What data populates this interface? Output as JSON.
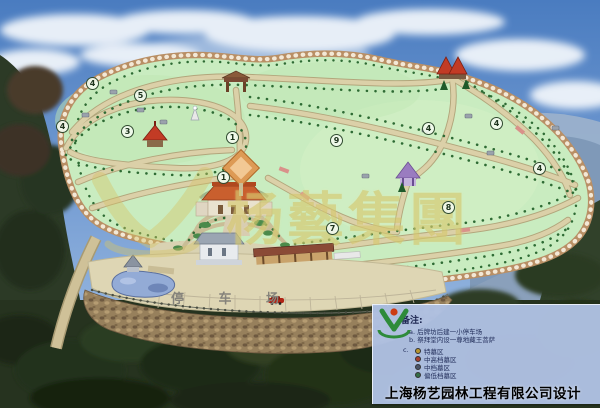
{
  "scene": {
    "watermark_text": "杨藝集團",
    "parking_label": "停 车 场",
    "markers": [
      {
        "label": "4",
        "x": 92,
        "y": 83
      },
      {
        "label": "5",
        "x": 140,
        "y": 95
      },
      {
        "label": "4",
        "x": 62,
        "y": 126
      },
      {
        "label": "3",
        "x": 127,
        "y": 131
      },
      {
        "label": "1",
        "x": 232,
        "y": 137
      },
      {
        "label": "9",
        "x": 336,
        "y": 140
      },
      {
        "label": "4",
        "x": 428,
        "y": 128
      },
      {
        "label": "4",
        "x": 496,
        "y": 123
      },
      {
        "label": "4",
        "x": 539,
        "y": 168
      },
      {
        "label": "1",
        "x": 223,
        "y": 177
      },
      {
        "label": "7",
        "x": 332,
        "y": 228
      },
      {
        "label": "8",
        "x": 448,
        "y": 207
      }
    ]
  },
  "legend": {
    "title": "备注:",
    "note_a_key": "a.",
    "note_a": "后牌坊后建一小停车场",
    "note_b_key": "b.",
    "note_b": "祭拜堂内设一尊地藏王菩萨",
    "note_c_key": "c.",
    "zones": [
      {
        "bullet_color": "#b8962e",
        "label": "特墓区"
      },
      {
        "bullet_color": "#a8402e",
        "label": "中高档墓区"
      },
      {
        "bullet_color": "#4a5568",
        "label": "中档墓区"
      },
      {
        "bullet_color": "#356e46",
        "label": "偏低档墓区"
      }
    ],
    "company": "上海杨艺园林工程有限公司设计"
  },
  "colors": {
    "sky_top": "#4a7cc0",
    "sky_bottom": "#a9c5e6",
    "map_green": "#c9ecc0",
    "road": "#dbd0a8",
    "wall": "#b98f65",
    "forest_dark": "#26331f",
    "mountain_blue": "#7f99b8",
    "legend_bg": "#b0c2e4",
    "parking": "#ded6b4",
    "pond": "#93abd6",
    "watermark": "#cebf5f"
  }
}
